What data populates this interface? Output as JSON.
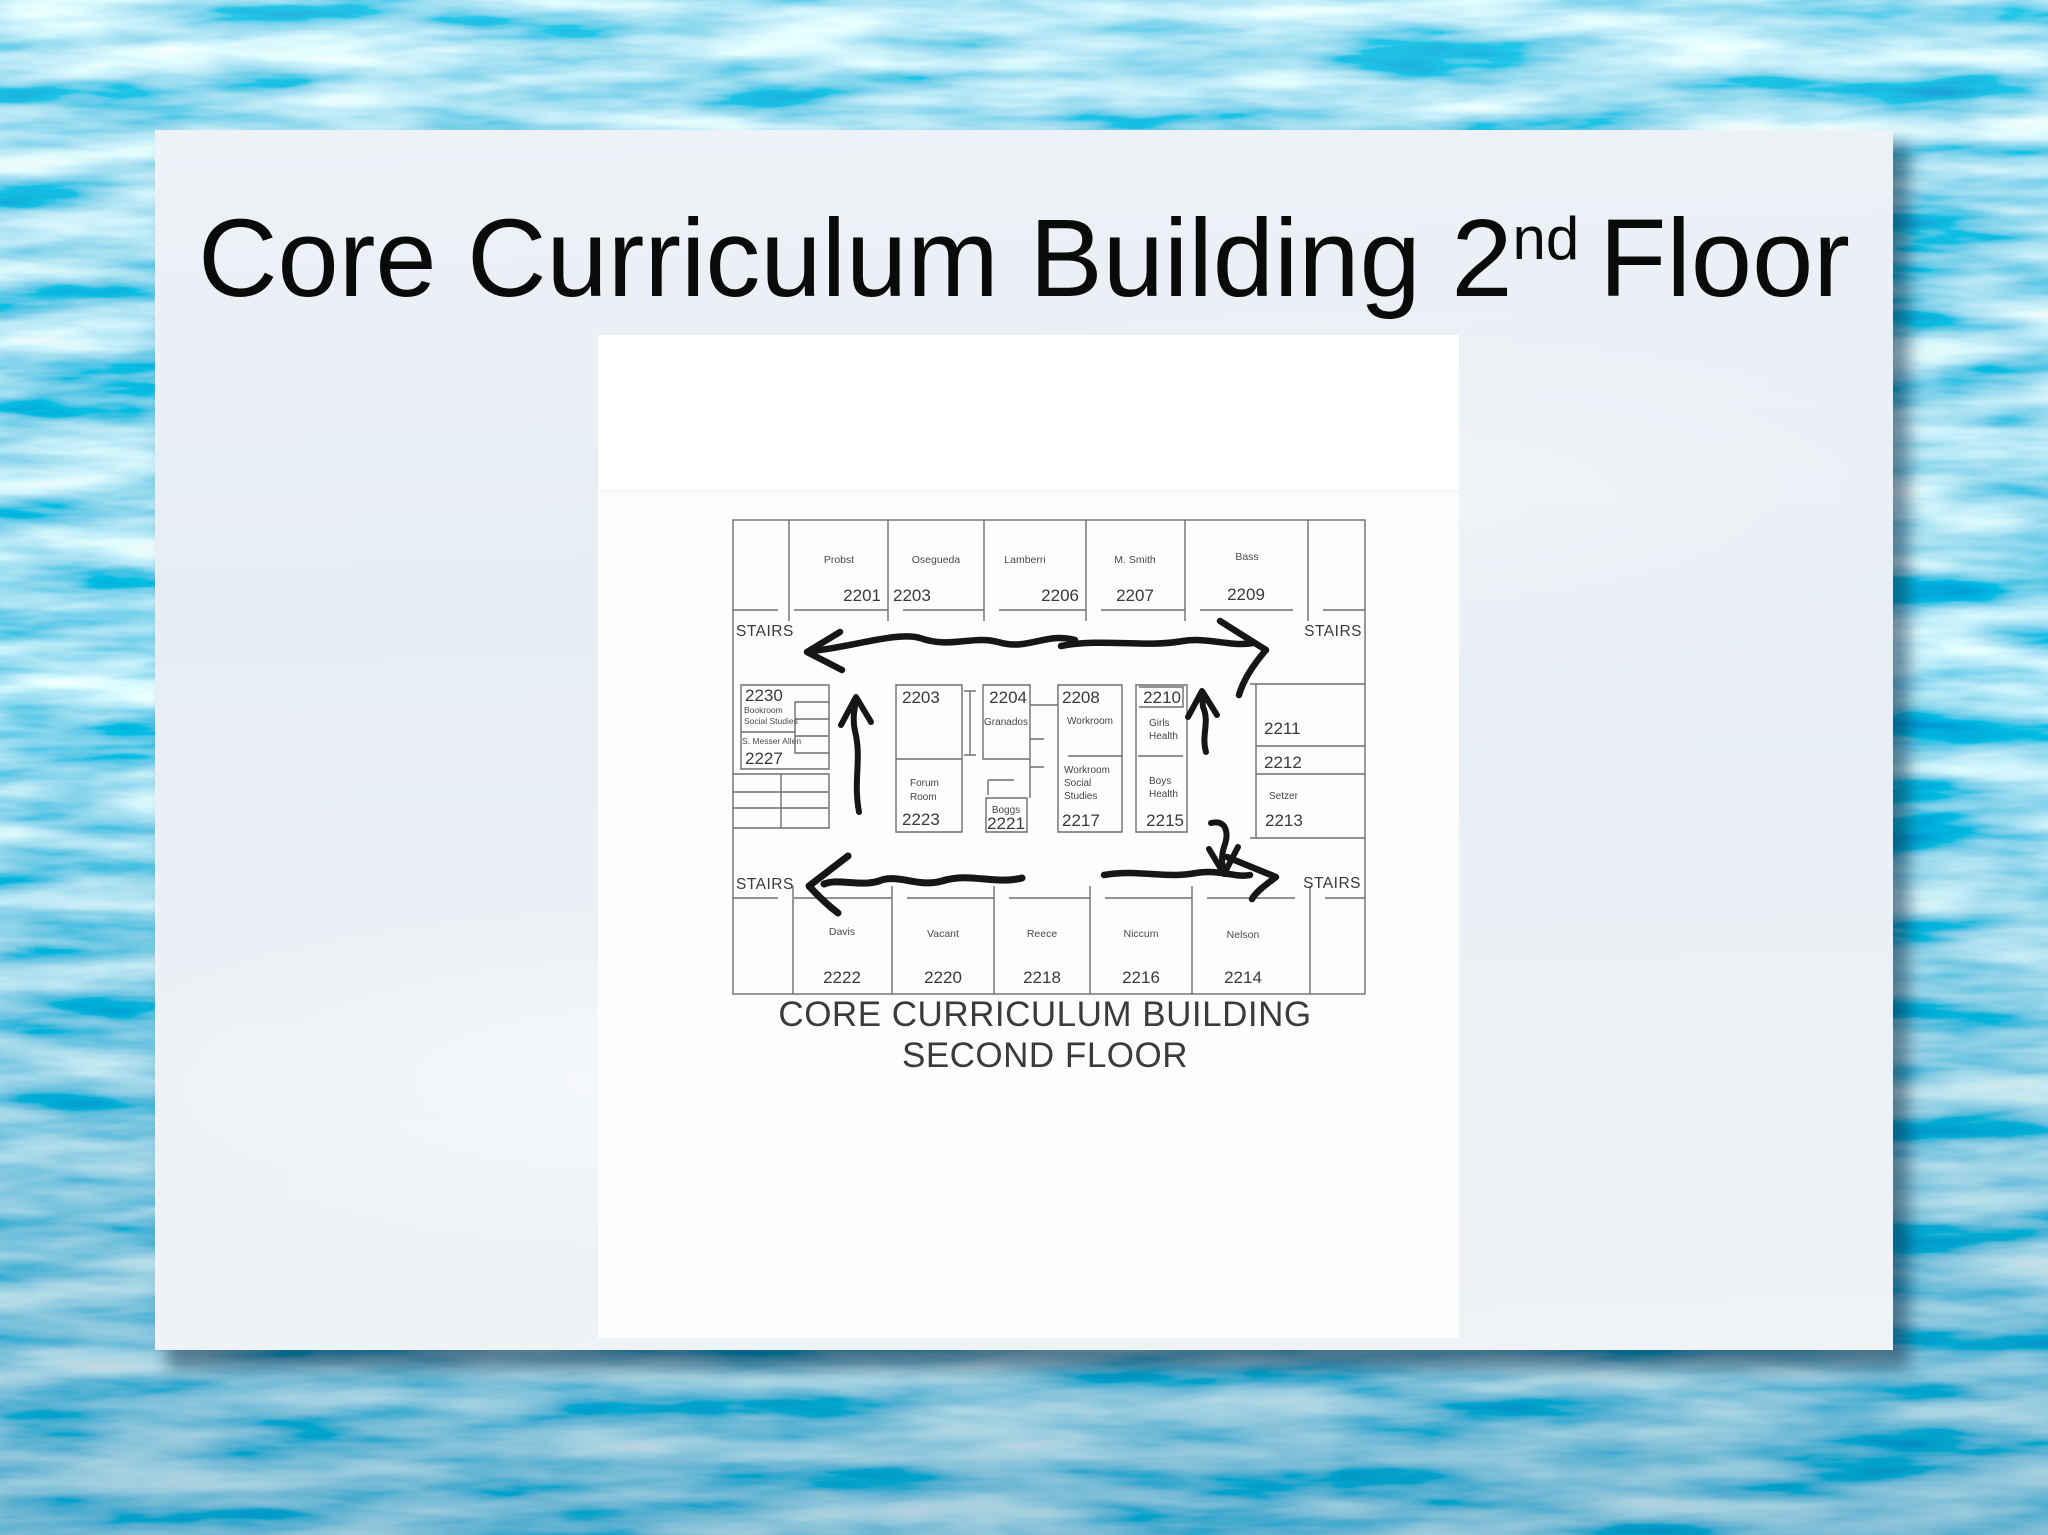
{
  "slide": {
    "title": {
      "text_main": "Core Curriculum Building 2",
      "superscript": "nd",
      "text_end": "Floor"
    },
    "floorplan": {
      "caption_line1": "CORE CURRICULUM BUILDING",
      "caption_line2": "SECOND FLOOR",
      "stairs": {
        "top_left": "STAIRS",
        "top_right": "STAIRS",
        "bottom_left": "STAIRS",
        "bottom_right": "STAIRS"
      },
      "top_row": [
        {
          "name": "Probst",
          "number": "2201"
        },
        {
          "name": "Osegueda",
          "number": "2203"
        },
        {
          "name": "Lamberri",
          "number": "2206"
        },
        {
          "name": "M. Smith",
          "number": "2207"
        },
        {
          "name": "Bass",
          "number": "2209"
        }
      ],
      "left_wing": {
        "number_2230": "2230",
        "bookroom_line1": "Bookroom",
        "bookroom_line2": "Social Studies",
        "occupant": "S. Messer Allen",
        "number_2227": "2227"
      },
      "center": {
        "number_2203": "2203",
        "number_2204": "2204",
        "granados": "Granados",
        "number_2208": "2208",
        "workroom": "Workroom",
        "number_2210": "2210",
        "girls_health": [
          "Girls",
          "Health"
        ],
        "forum_room": [
          "Forum",
          "Room"
        ],
        "number_2223": "2223",
        "boggs": "Boggs",
        "number_2221": "2221",
        "workroom_social_studies": [
          "Workroom",
          "Social",
          "Studies"
        ],
        "number_2217": "2217",
        "boys_health": [
          "Boys",
          "Health"
        ],
        "number_2215": "2215"
      },
      "right_wing": {
        "number_2211": "2211",
        "number_2212": "2212",
        "setzer": "Setzer",
        "number_2213": "2213"
      },
      "bottom_row": [
        {
          "name": "Davis",
          "number": "2222"
        },
        {
          "name": "Vacant",
          "number": "2220"
        },
        {
          "name": "Reece",
          "number": "2218"
        },
        {
          "name": "Niccum",
          "number": "2216"
        },
        {
          "name": "Nelson",
          "number": "2214"
        }
      ]
    }
  },
  "colors": {
    "water_mid": "#45acd6",
    "water_deep": "#1d7fae",
    "water_light": "#9adcf0",
    "slide_background": "#eaf0f6",
    "paper": "#fdfdfe",
    "wall_gray": "#6e6e6e",
    "label_gray": "#3f3f3f",
    "marker_ink": "#161616",
    "title_black": "#0a0a0a"
  }
}
